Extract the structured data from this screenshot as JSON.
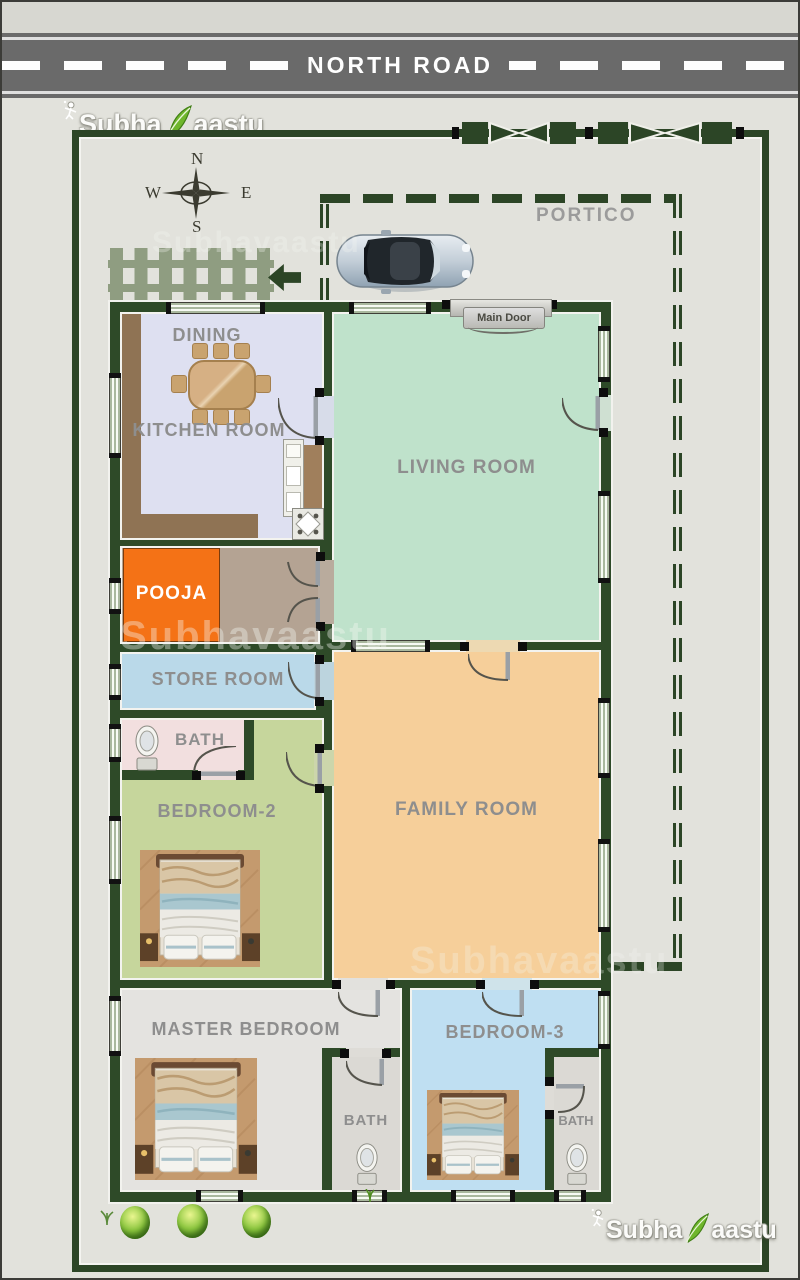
{
  "road": {
    "label": "NORTH ROAD"
  },
  "brand": {
    "part1": "Subha",
    "part2": "aastu"
  },
  "compass": {
    "n": "N",
    "e": "E",
    "s": "S",
    "w": "W"
  },
  "portico": {
    "label": "PORTICO"
  },
  "main_door": {
    "label": "Main Door"
  },
  "rooms": {
    "dining": "DINING",
    "kitchen": "KITCHEN ROOM",
    "living": "LIVING ROOM",
    "pooja": "POOJA",
    "store": "STORE ROOM",
    "bath_west": "BATH",
    "bedroom2": "BEDROOM-2",
    "family": "FAMILY ROOM",
    "master": "MASTER BEDROOM",
    "bedroom3": "BEDROOM-3",
    "bath_master": "BATH",
    "bath_east": "BATH"
  },
  "watermark": "Subhavaastu",
  "colors": {
    "wall": "#2e4a28",
    "kitchen_floor": "#dee0f1",
    "living_floor": "#bfe2cb",
    "family_floor": "#f6cf9a",
    "bedroom2_floor": "#c6d69c",
    "bedroom3_floor": "#bfdff2",
    "store_floor": "#bad9e9",
    "bath_floor": "#f2dfdf",
    "pooja_accent": "#f47216",
    "master_floor": "#e4e3e0",
    "passage_floor": "#b4a393",
    "road": "#6a6a6a",
    "background": "#e2e2dc",
    "logo_leaf": "#6fb62c"
  }
}
